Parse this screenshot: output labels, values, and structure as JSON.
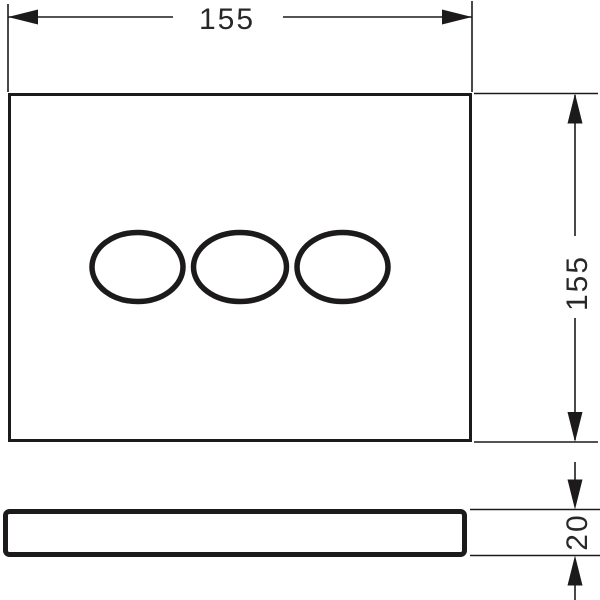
{
  "drawing": {
    "top_width": {
      "label": "155"
    },
    "right_height": {
      "label": "155"
    },
    "side_depth": {
      "label": "20"
    }
  },
  "colors": {
    "line": "#1c1a1b",
    "background": "#ffffff"
  }
}
